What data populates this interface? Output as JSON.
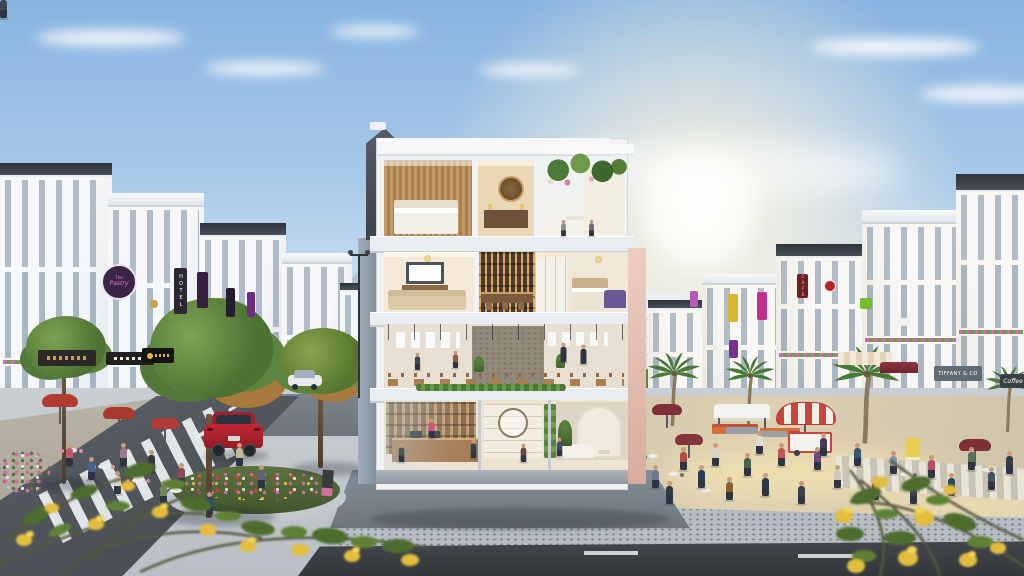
{
  "signs": {
    "pastry_line1": "The",
    "pastry_line2": "Pastry",
    "hotel": "HOTEL",
    "cafe_vertical": "CAFE",
    "tiffany": "TIFFANY & CO",
    "coffee": "Coffee"
  },
  "palette": {
    "sky_top": "#87b3e0",
    "sky_horizon": "#eef3f7",
    "sun_glow": "#fff7e0",
    "facade_white": "#f4f5f6",
    "roof_dark": "#3c4148",
    "mansard_tower": "#474c54",
    "slab": "#e9edef",
    "interior_wood": "#b98e5c",
    "interior_warm": "#f3e9d6",
    "bar_shelf": "#4e392a",
    "purple_sofa": "#6b5693",
    "road_asphalt": "#3d4145",
    "street_left": "#4a4f54",
    "sidewalk_speckled": "#b7bdc3",
    "plaza_warm": "#d9cdb0",
    "apron_gray": "#79838c",
    "tree_green": "#567c3a",
    "autumn_orange": "#b5803f",
    "palm_green": "#477a36",
    "flower_yellow": "#e5be3c",
    "flower_pink": "#d06f9a",
    "car_red": "#b6252f",
    "umbrella_red": "#b23c35",
    "umbrella_maroon": "#7e3036",
    "market_stripe_red": "#c9463d",
    "chair_pink": "#d98ea6",
    "sign_purple": "#7a2f93",
    "sign_magenta": "#c2308f",
    "sign_yellow": "#d9b530",
    "sign_green": "#76bd2e",
    "cafe_sign_red": "#6e2026",
    "tiffany_sign_gray": "#5f6a75",
    "pastry_sign_bg": "#3a2546",
    "pastry_sign_pink": "#e77fb1"
  }
}
